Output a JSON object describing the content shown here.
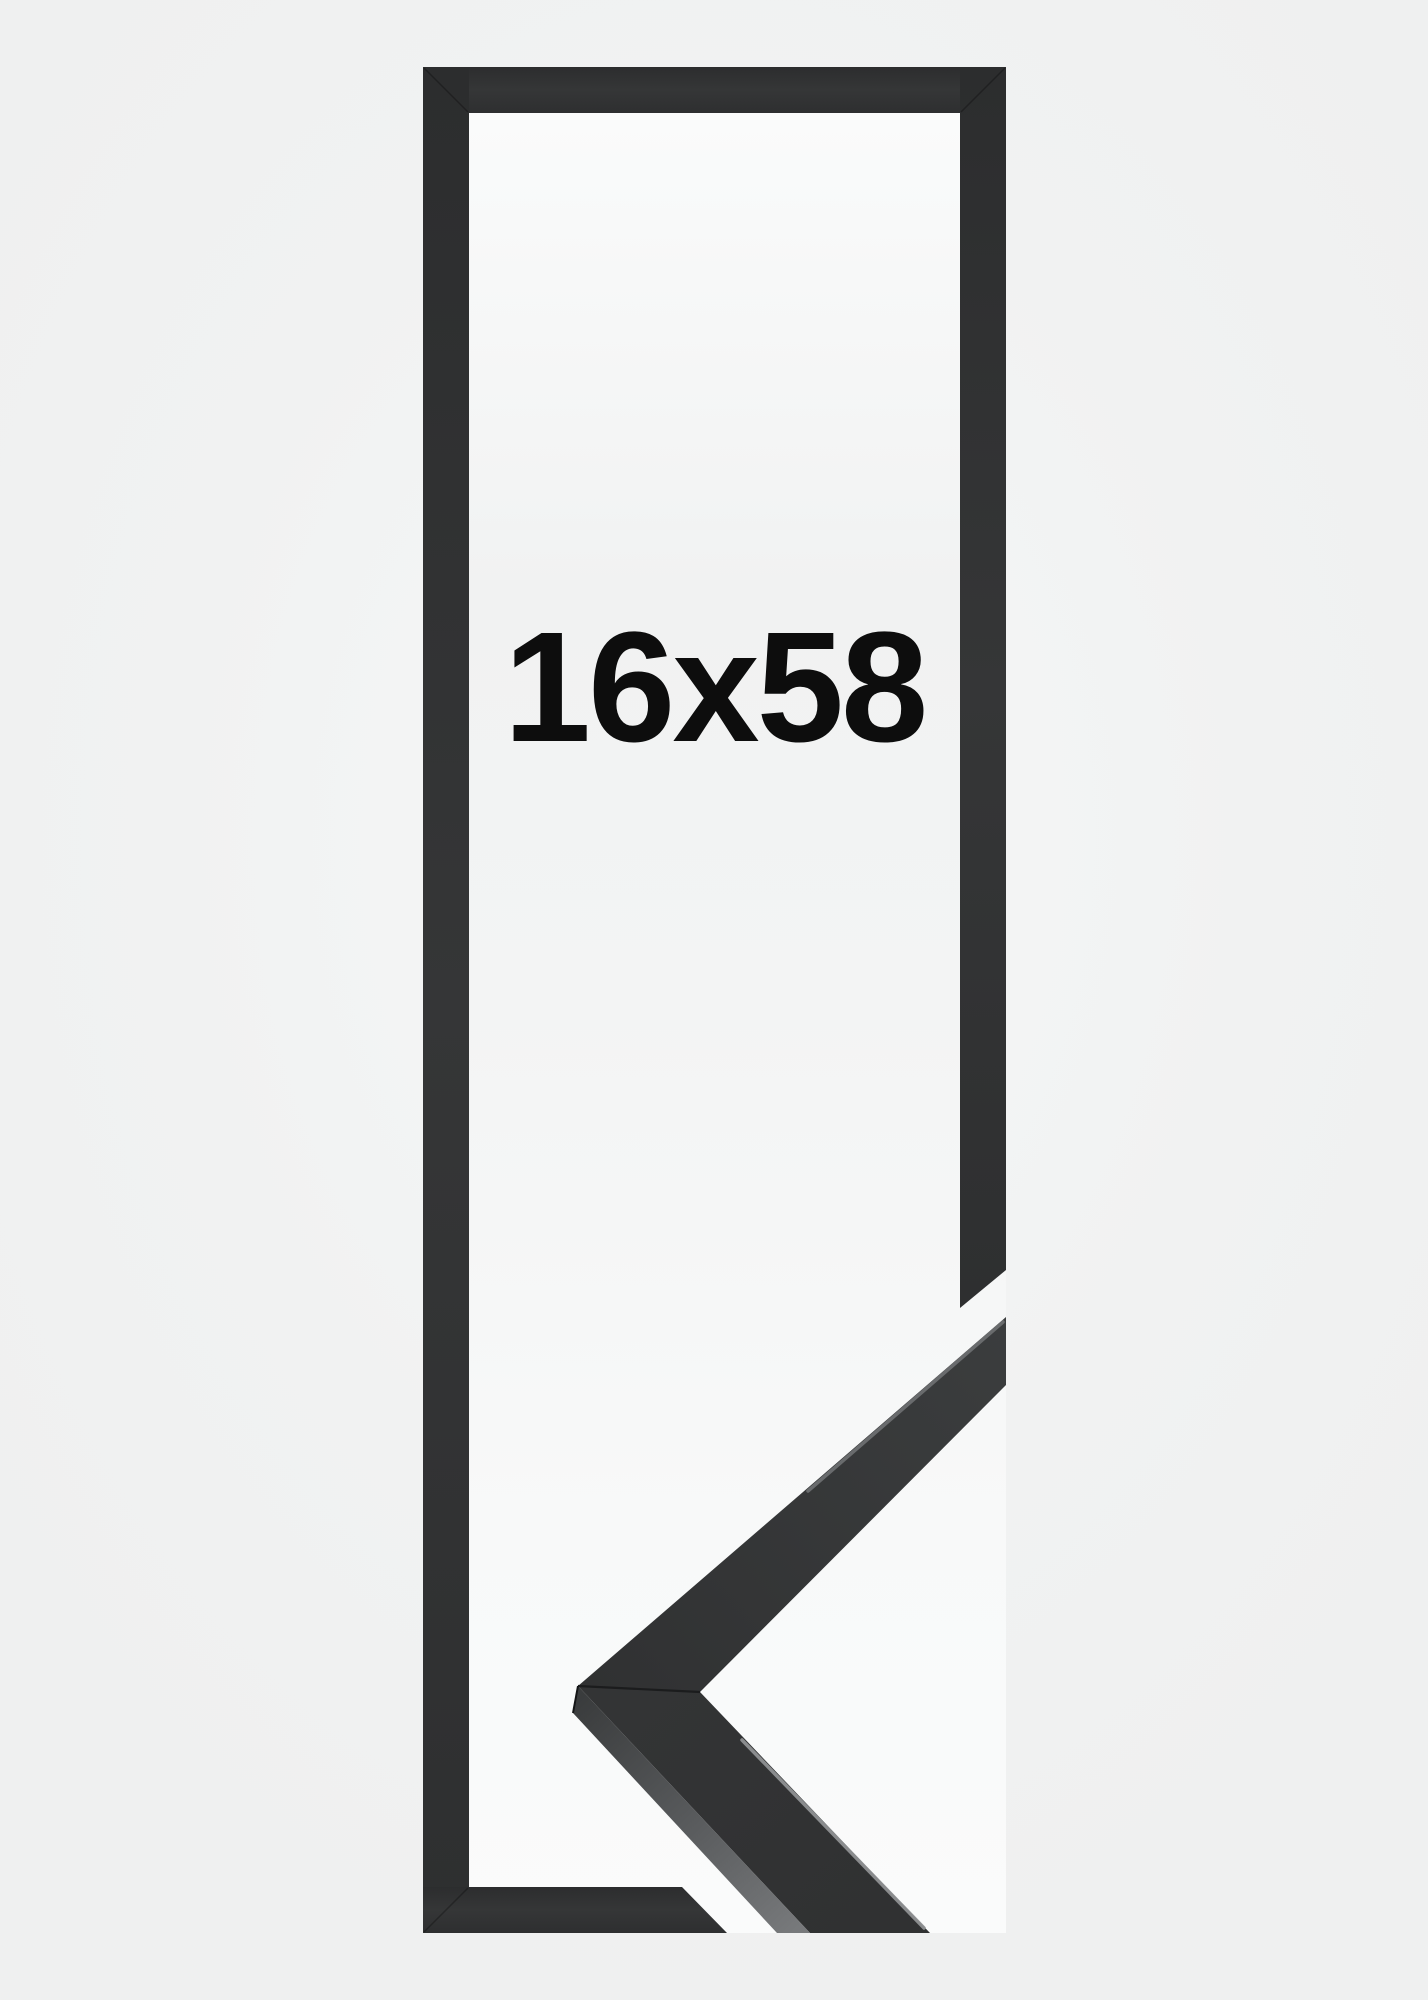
{
  "product": {
    "size_label": "16x58"
  },
  "colors": {
    "page_background": "#f0f1f1",
    "canvas_background_top": "#fbfcfc",
    "canvas_background_mid": "#f1f2f2",
    "canvas_background_bottom": "#fafbfb",
    "frame_black": "#313233",
    "frame_black_dark": "#2b2c2d",
    "corner_face_black": "#343536",
    "corner_bevel_light": "#77797b",
    "edge_highlight": "#8f9193",
    "miter_seam": "#1b1c1d",
    "label_text": "#0d0d0d"
  }
}
